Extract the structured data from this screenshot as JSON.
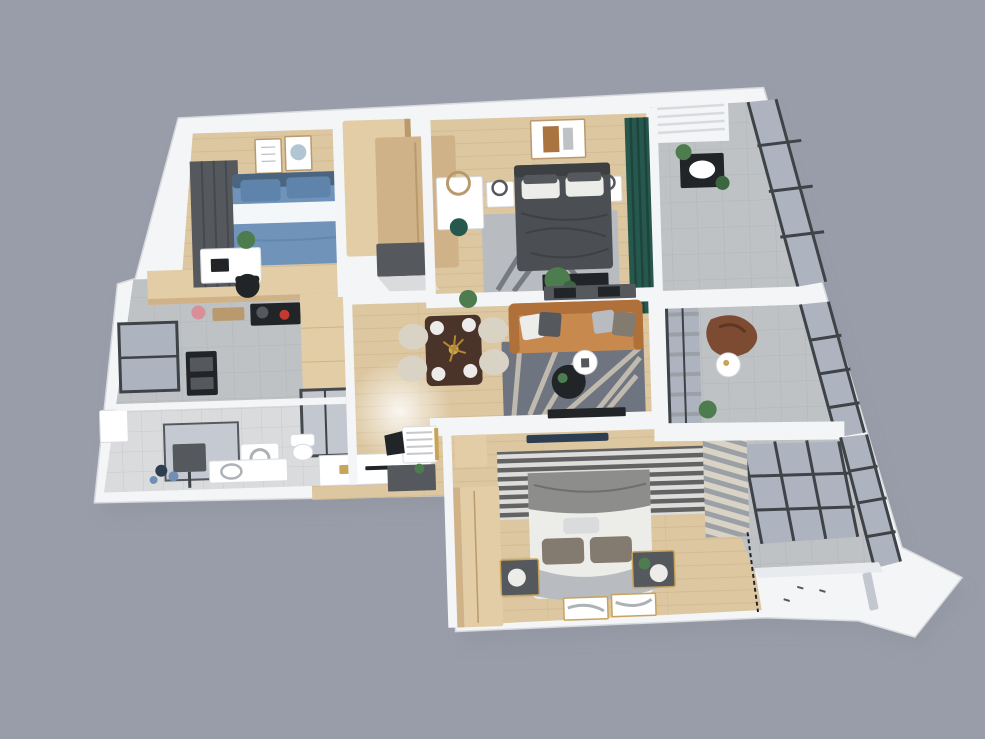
{
  "scene": {
    "subject": "3D rendered apartment floor plan, top-down isometric view",
    "style": "photorealistic architectural render on plain gray backdrop",
    "text_visible": "none"
  },
  "colors": {
    "bg": "#999da9",
    "shadow": "#80859233",
    "wall": "#f4f5f7",
    "wall-edge": "#d7dadf",
    "wall-face": "#e9eaee",
    "wood": "#dcc7a1",
    "wood-line": "#cdb astra",
    "wood-plank-line": "#cbb189",
    "wood-cab": "#e3cda6",
    "wood-cab-dark": "#cfb287",
    "wood-cab-side": "#b99a6d",
    "tile": "#bfc2c5",
    "tile-line": "#aeb1b5",
    "tile-light": "#dadbdc",
    "tile-light-line": "#c6c8ca",
    "glass": "#aeb4bf",
    "glass-light": "#c2c7d0",
    "frame": "#3e4348",
    "teal": "#27584e",
    "teal-dark": "#1d453d",
    "sofa": "#c8894f",
    "sofa-dark": "#b0703a",
    "rug-living": "#6e7480",
    "rug-branch": "#cfc7b6",
    "blue-bed": "#7094b9",
    "blue-bed-dark": "#5f84ab",
    "dark-bed": "#4b4e52",
    "dark-bed-line": "#3d4043",
    "master-rug": "#b8bbc0",
    "master-rug-dark": "#5a5e66",
    "bed2-white": "#ecece9",
    "bed2-gray": "#8d8d8b",
    "pillow-tan": "#837a70",
    "stripe-dark": "#4e4e4e",
    "stripe-light": "#dddddc",
    "curtain-gray": "#9aa0a6",
    "cream": "#d9d3c6",
    "table-wood": "#4a3429",
    "leather": "#7c4b32",
    "plant": "#4d7c4f",
    "plant-dark": "#3c663f",
    "gold": "#c8a45a",
    "black": "#222528",
    "gray-box": "#55585c",
    "navy": "#2e3e52",
    "white": "#ffffff",
    "pink": "#d98f97"
  },
  "rooms": [
    {
      "name": "bedroom-1",
      "position": "top-left",
      "furniture": [
        "blue-double-bed",
        "window-with-gray-curtain",
        "two-wall-art-frames",
        "white-desk",
        "black-desk-chair",
        "potted-plant",
        "wood-wardrobe"
      ]
    },
    {
      "name": "master-bedroom",
      "position": "top-center",
      "furniture": [
        "dark-gray-double-bed",
        "white-nightstands-with-lamps",
        "vanity-desk-with-round-mirror",
        "teal-stool",
        "wall-art",
        "gray-area-rug",
        "end-of-bed-console",
        "plant",
        "teal-curtains"
      ]
    },
    {
      "name": "walk-in-closet",
      "position": "top-center-left",
      "furniture": [
        "wood-cabinet-tall",
        "wood-cabinet-low",
        "gray-ottoman"
      ]
    },
    {
      "name": "living-room",
      "position": "center",
      "furniture": [
        "tan-leather-sofa",
        "throw-pillows",
        "gray-branch-pattern-rug",
        "round-coffee-table-dark",
        "round-tray-table-white",
        "wall-tv",
        "console-with-plants"
      ]
    },
    {
      "name": "dining-area",
      "position": "center-left",
      "furniture": [
        "dark-wood-dining-table",
        "four-cream-chairs",
        "place-settings",
        "centerpiece-flowers"
      ]
    },
    {
      "name": "kitchen",
      "position": "left",
      "furniture": [
        "wood-upper-cabinets",
        "cooktop-with-pots",
        "cutting-board",
        "pink-pot",
        "built-in-oven-stack",
        "tall-wood-cabinet",
        "window",
        "glass-partition"
      ]
    },
    {
      "name": "bathroom-laundry",
      "position": "bottom-left",
      "furniture": [
        "shower-with-glass-screen",
        "shower-head",
        "washing-machine",
        "white-vanity",
        "toilet",
        "radiator",
        "blue-laundry-caddy"
      ]
    },
    {
      "name": "hallway-entry",
      "position": "bottom-center-left",
      "furniture": [
        "white-console",
        "small-white-desk",
        "black-chair",
        "dark-gray-cabinet",
        "ceiling-light-glow"
      ]
    },
    {
      "name": "bedroom-2",
      "position": "bottom-center",
      "furniture": [
        "white-bed-gray-throw",
        "gray-pillows",
        "striped-monochrome-rug",
        "tall-wood-wardrobe",
        "wood-cabinet",
        "dark-nightstands-gold-trim",
        "leaning-art-canvases",
        "navy-bench",
        "large-grid-window",
        "gray-curtain-stack"
      ]
    },
    {
      "name": "balcony-top-right",
      "position": "top-right",
      "furniture": [
        "slatted-ceiling-unit",
        "washbasin-counter",
        "potted-plants",
        "glass-curtain-wall"
      ]
    },
    {
      "name": "balcony-mid-right",
      "position": "right",
      "furniture": [
        "brown-leather-beanbag",
        "round-white-side-table",
        "potted-plant",
        "glass-curtain-wall",
        "blind-slats"
      ]
    },
    {
      "name": "balcony-bottom-right",
      "position": "bottom-right",
      "furniture": [
        "vertical-blind-slats",
        "glass-curtain-wall",
        "white-bay-ledge"
      ]
    }
  ]
}
